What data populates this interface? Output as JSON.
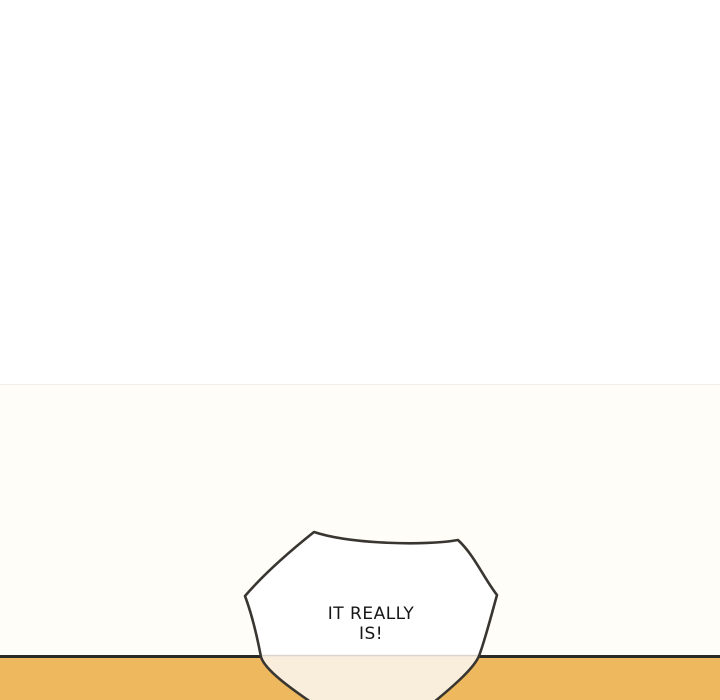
{
  "scene": {
    "type": "webtoon-comic-panel",
    "speech_bubble": {
      "full_text": "IT REALLY IS!",
      "lines": [
        "IT REALLY",
        "IS!"
      ]
    }
  },
  "colors": {
    "page_bg": "#ffffff",
    "panel_bg": "#fffdf8",
    "panel_divider": "#f2efe6",
    "ground_line": "#2b2924",
    "ground_fill": "#edb85e",
    "bubble_fill": "#ffffff",
    "bubble_fill_below_ground": "#f8eedb",
    "bubble_ground_divider": "#d9d5ca",
    "bubble_outline": "#393631",
    "text_color": "#161616"
  }
}
